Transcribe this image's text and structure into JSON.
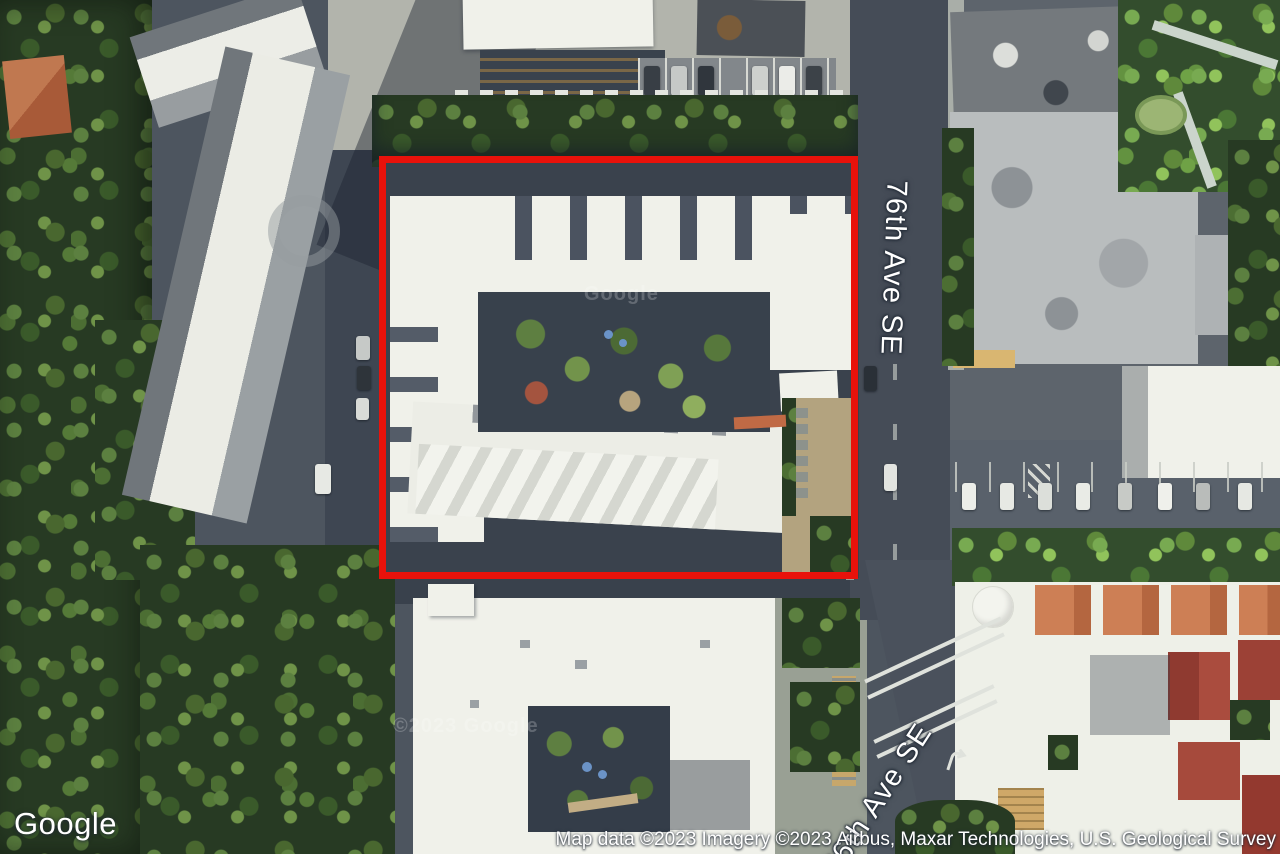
{
  "map": {
    "street_labels": {
      "main": "76th Ave SE",
      "secondary": "76th Ave SE"
    },
    "watermarks": {
      "center": "Google",
      "south": "©2023 Google"
    },
    "parcel_outline_color": "#e8120b"
  },
  "footer": {
    "logo": "Google",
    "attribution": "Map data ©2023 Imagery ©2023 Airbus, Maxar Technologies, U.S. Geological Survey"
  }
}
